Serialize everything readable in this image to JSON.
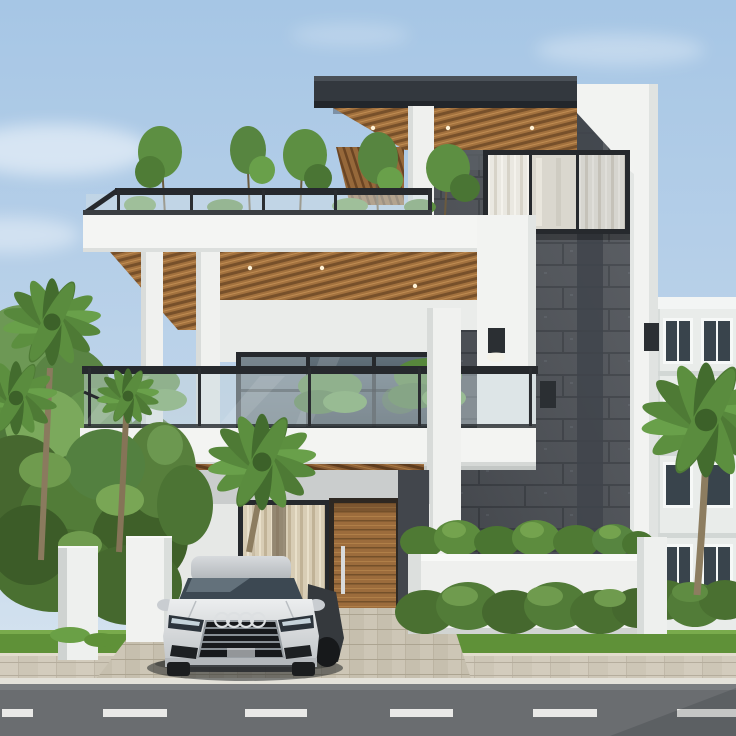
{
  "scene": {
    "type": "photorealistic architectural exterior render",
    "setting": "modern two-story villa with rooftop terrace, viewed from the street, clear daytime sky",
    "main_house": {
      "style": "contemporary white villa with dark granite feature tower, wood slat soffit ceilings and glass railings",
      "levels": "ground floor + upper floor + rooftop terrace",
      "features": [
        "rooftop terrace with slender trees behind glass railing",
        "second-floor balcony with palm plants and glass railing",
        "wood slat ceilings with recessed downlights",
        "dark stone tower with tall curtained windows",
        "tall white columns",
        "wooden entry door with vertical steel handle",
        "curtained floor-to-ceiling glass door",
        "white planter wall with shrub row",
        "black wall sconce lamps"
      ]
    },
    "vehicle": {
      "type": "silver sedan",
      "badge": "four overlapping chrome rings on black grille",
      "position": "parked in the driveway facing the street"
    },
    "landscaping": [
      "palm trees left and right",
      "dense hedge mass on the left",
      "boxwood hedge row in front of planter",
      "lawn strips along sidewalk"
    ],
    "street": {
      "sidewalk": "beige paver sidewalk with curb",
      "road": "grey asphalt",
      "lane_marking": "white dashed center line",
      "dash_count": 6
    },
    "neighbor_building": {
      "type": "white multi-story apartment block on the right",
      "window_style": "dark glass with white frames",
      "visible_window_rows": 4
    }
  },
  "colors": {
    "sky_top": "#a6c6e5",
    "sky_horizon": "#dbe7f1",
    "wall_white": "#f2f3f1",
    "fascia_white": "#f4f5f3",
    "balcony_slab": "#f3f4f2",
    "column_white": "#f0f1ef",
    "roof_cap": "#33383e",
    "stone": "#4b4f55",
    "stone_strip": "#3f444b",
    "wood_soffit": "#a2713e",
    "wood_ground": "#8a5d34",
    "window_frame": "#26292d",
    "railing_metal": "#26292d",
    "curtain_white": "#eae8e1",
    "curtain_beige": "#d8cdb5",
    "door_wood": "#9c6c3c",
    "door_handle": "#d8dadb",
    "lamp": "#2b2f33",
    "foliage": "#5c8f3f",
    "hedge": "#4a7031",
    "grass": "#5f9138",
    "palm_trunk": "#8d7d60",
    "planter_white": "#eff0ee",
    "boundary_wall": "#eef0ee",
    "neighbor_wall": "#e9ecea",
    "neighbor_window": "#39444c",
    "sidewalk": "#d3ccbd",
    "driveway": "#cdc6b6",
    "curb": "#e4e2da",
    "road": "#6a6d70",
    "road_dash": "#e9e9e7",
    "car_body": "#d9dcde",
    "car_glass": "#3c4852",
    "car_grille": "#17191c"
  }
}
